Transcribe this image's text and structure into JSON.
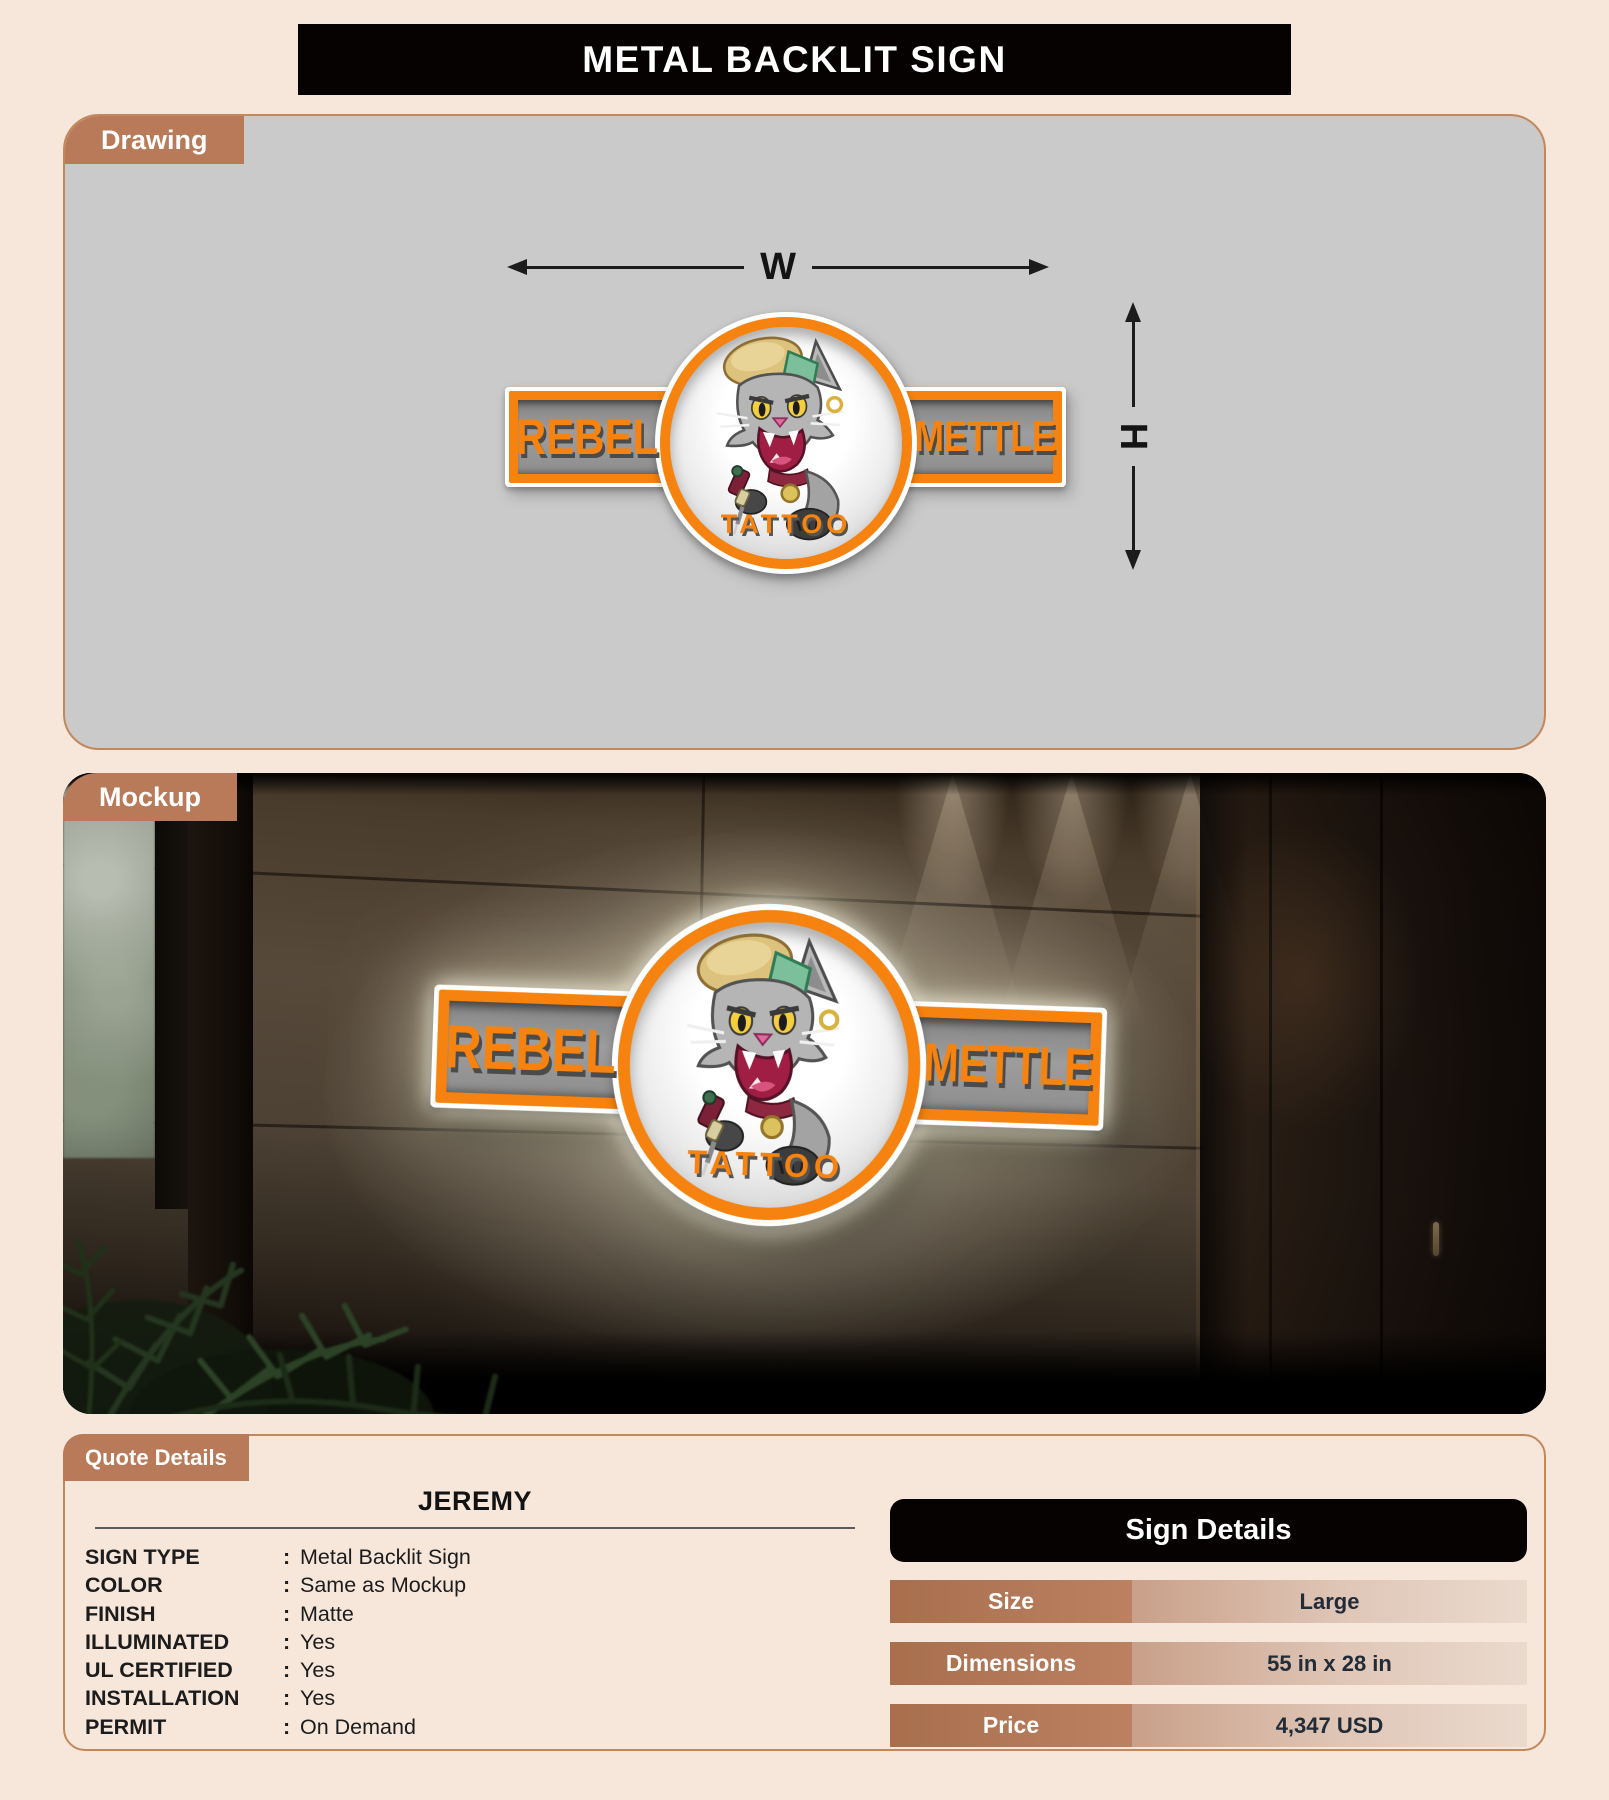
{
  "title": "METAL BACKLIT SIGN",
  "drawing": {
    "tab": "Drawing",
    "width_label": "W",
    "height_label": "H"
  },
  "mockup": {
    "tab": "Mockup"
  },
  "logo": {
    "left_text": "REBEL",
    "right_text": "METTLE",
    "bottom_text": "TATTOO"
  },
  "quote": {
    "tab": "Quote Details",
    "customer": "JEREMY",
    "colon": ":",
    "rows": [
      {
        "label": "SIGN TYPE",
        "value": "Metal Backlit Sign"
      },
      {
        "label": "COLOR",
        "value": "Same as Mockup"
      },
      {
        "label": "FINISH",
        "value": "Matte"
      },
      {
        "label": "ILLUMINATED",
        "value": "Yes"
      },
      {
        "label": "UL CERTIFIED",
        "value": "Yes"
      },
      {
        "label": "INSTALLATION",
        "value": "Yes"
      },
      {
        "label": "PERMIT",
        "value": "On Demand"
      }
    ]
  },
  "sign_details": {
    "title": "Sign Details",
    "rows": [
      {
        "label": "Size",
        "value": "Large"
      },
      {
        "label": "Dimensions",
        "value": "55 in x 28 in"
      },
      {
        "label": "Price",
        "value": "4,347 USD"
      }
    ]
  },
  "colors": {
    "accent_terracotta": "#b87a59",
    "logo_orange": "#f6830f",
    "page_background": "#f7e7db",
    "drawing_background": "#cacaca",
    "header_black": "#070202"
  }
}
